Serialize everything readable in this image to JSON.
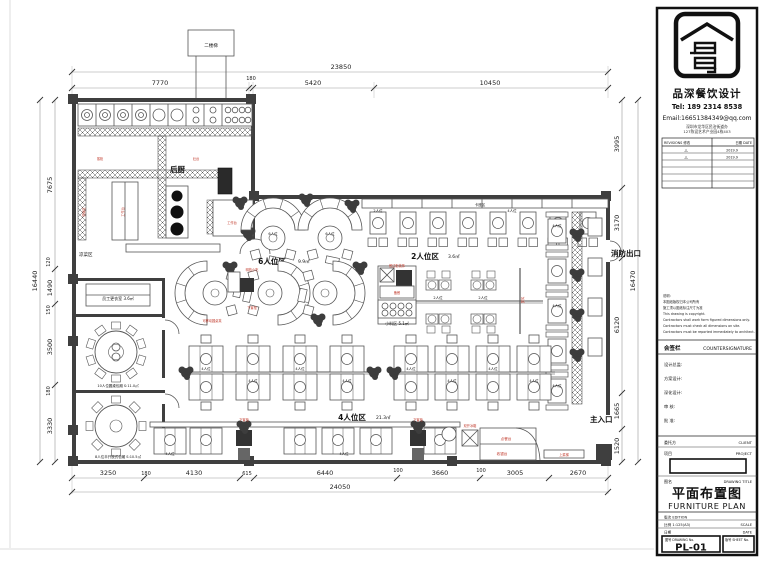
{
  "title_block": {
    "company": "品深餐饮设计",
    "tel": "Tel: 189 2314 8538",
    "email": "Email:16651384349@qq.com",
    "address_line1": "深圳市龙华区民治街道办",
    "address_line2": "127陈设艺术产业园4栋403",
    "revisions_header_left": "REVISIONS 修改",
    "revisions_header_right": "日期 DATE",
    "revision_rows": [
      {
        "mark": "△",
        "date": "2019.9"
      },
      {
        "mark": "△",
        "date": "2019.9"
      }
    ],
    "notes": [
      "说明:",
      "本图纸版权归本公司所有",
      "施工须以图纸标注尺寸为准",
      "This drawing is copyright.",
      "Contractors shall work form figured dimensions only.",
      "Contractors must check all dimensions on site.",
      "Contractors must be reported immediately to architect."
    ],
    "countersign_zh": "会签栏",
    "countersign_en": "COUNTERSIGNATURE",
    "sign_lines": [
      "设计总监:",
      "方案设计:",
      "深化设计:",
      "审 核:",
      "批 准:"
    ],
    "client_zh": "委托方",
    "client_en": "CLIENT",
    "project_zh": "项目",
    "project_en": "PROJECT",
    "drawing_title_label_zh": "图名",
    "drawing_title_label_en": "DRAWING TITLE",
    "drawing_title_zh": "平面布置图",
    "drawing_title_en": "FURNITURE PLAN",
    "edition_row": "版次 EDITION",
    "scale_value": "比例 1:125(A3)",
    "scale_en": "SCALE",
    "date_label": "日期",
    "date_en": "DATE",
    "sheet_no_label": "图号 DRAWING No.",
    "sheet_number": "PL-01",
    "sheet_label": "版号 SHEET No."
  },
  "dims": {
    "top": {
      "overall": "23850",
      "segments": [
        "7770",
        "180",
        "5420",
        "10450"
      ]
    },
    "left": {
      "overall": "16440",
      "segments": [
        "7675",
        "120",
        "1490",
        "150",
        "3500",
        "180",
        "3330"
      ]
    },
    "right": {
      "overall": "16470",
      "segments": [
        "3995",
        "3170",
        "6120",
        "1665",
        "1520"
      ]
    },
    "bottom": {
      "overall": "24050",
      "segments": [
        "3250",
        "180",
        "4130",
        "615",
        "6440",
        "100",
        "3660",
        "100",
        "3005",
        "2670"
      ]
    }
  },
  "zones": {
    "kitchen": "后厨",
    "cold_dish": "凉菜区",
    "stairs": "二楼梯",
    "zone6_name": "6人位区",
    "zone6_area": "9.9㎡",
    "booth_strip": "卡座区",
    "zone2_name": "2人位区",
    "zone2_area": "3.6㎡",
    "zone4_name": "4人位区",
    "zone4_area": "21.3㎡",
    "spice_zone": "小料区 5.1㎡",
    "changing_room": "员工更衣室 3.6㎡",
    "round10_room": "10人位圆桌包厢 S:11.0㎡",
    "round8_room": "8人位半开放式包厢 S:10.5㎡",
    "fire_exit": "消防出口",
    "main_entrance": "主入口"
  },
  "furniture": {
    "seat2": "2人位",
    "seat4": "4人位",
    "seat6": "6人位",
    "worktable": "工作台",
    "steamer": "蒸柜",
    "stove": "灶台",
    "dishwash": "洗碗区",
    "prep": "备餐",
    "snack_counter": "明档小吃",
    "sideboard": "餐边柜装饰",
    "under_cabinet": "下置柜",
    "movable_stool": "可移动圆桌凳",
    "screen": "屏风",
    "plant_label": "绿植",
    "cashier": "收银台",
    "order_counter": "点餐台",
    "fridge": "双开冰箱",
    "dish_lift": "上菜梯"
  },
  "colors": {
    "accent_red": "#c0392b",
    "line_dark": "#3f3f3f"
  }
}
